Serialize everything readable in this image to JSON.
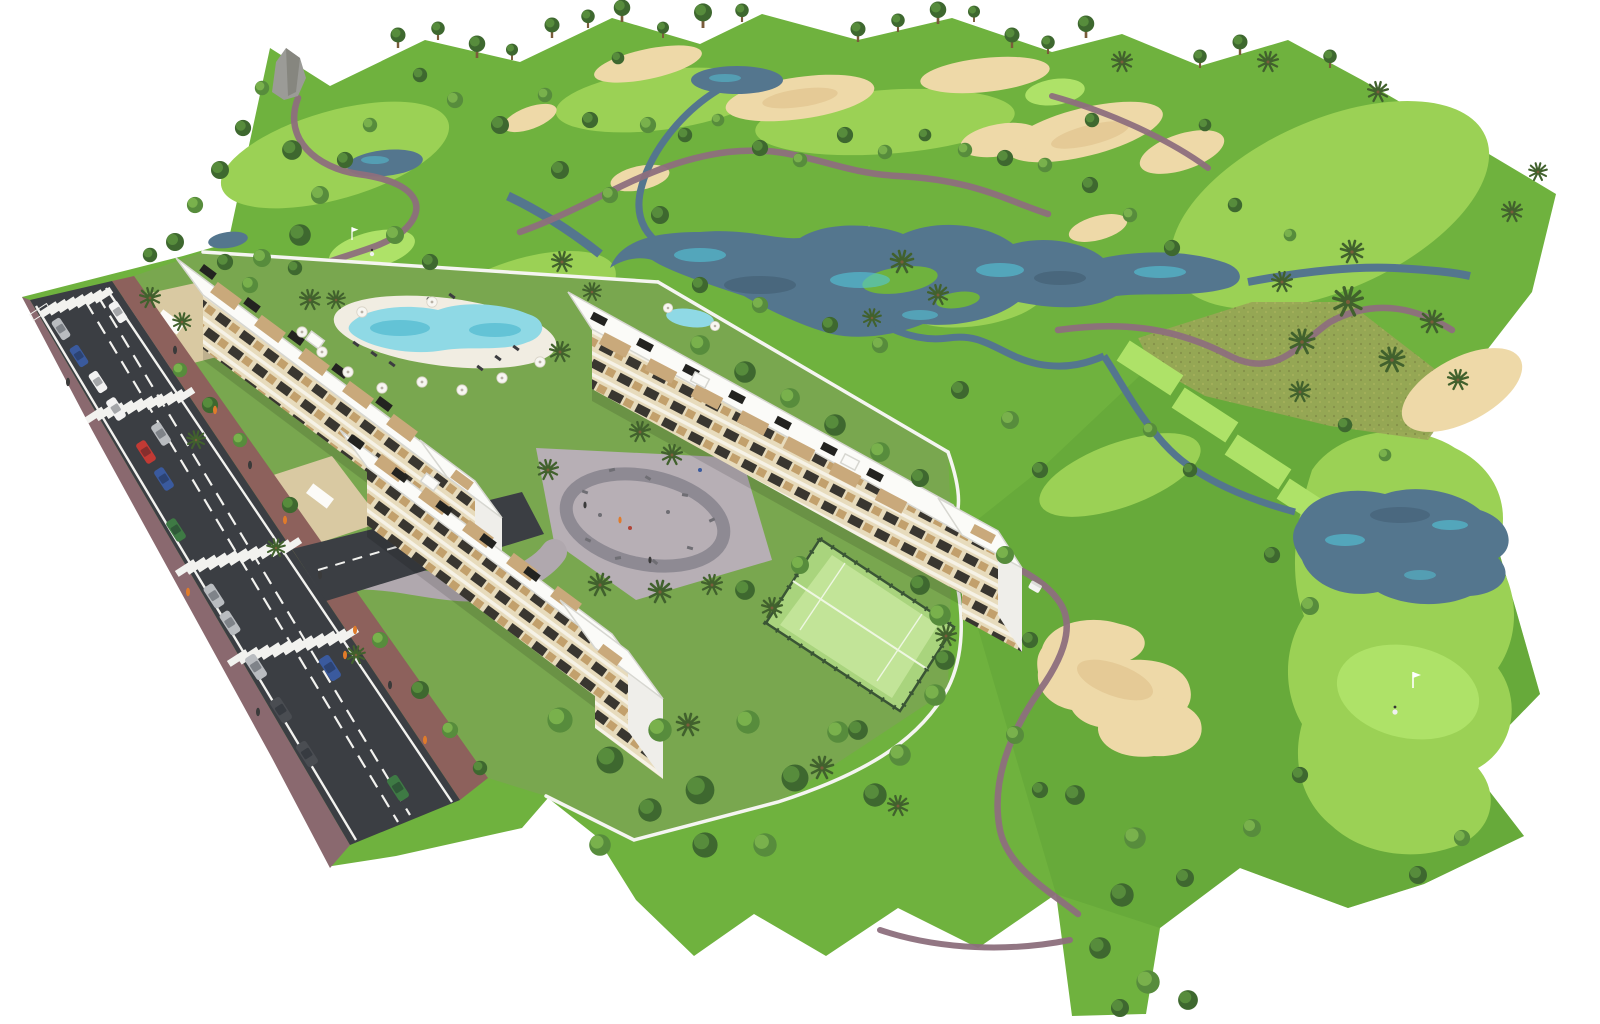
{
  "scene": {
    "title": "Golf resort apartment development — aerial 3D render",
    "description": "Bird's-eye architectural rendering of three white apartment blocks with roof terraces and wood-tone facades beside a golf course with lakes, sand bunkers, cart paths and palm trees; a street with parked cars and zebra crossings runs along the lower-left, with a lagoon pool, playground plaza and fenced padel courts inside the complex.",
    "background_color": "#ffffff"
  },
  "palette": {
    "grass": "#6fb23e",
    "grassDark": "#61a437",
    "devGrass": "#79a74f",
    "fairway": "#9bd155",
    "tee": "#aee268",
    "rough": "#99a557",
    "sand": "#eed9a8",
    "sandEdge": "#dbbc84",
    "water": "#54768e",
    "waterDeep": "#3c5668",
    "waterGlint": "#54c6d8",
    "path": "#8d6f7d",
    "road": "#3b3e43",
    "roadLine": "#f2f2ef",
    "sidewalk": "#8a696f",
    "sidewalkRed": "#8d615c",
    "wall": "#f5f5f1",
    "roof": "#fbfbf8",
    "roofLine": "#d7d7d1",
    "endWall": "#efeeea",
    "facade": "#e7dbbc",
    "facadeBand": "#f6f2e6",
    "facadeWin": "#393630",
    "facadeWood": "#c2a06c",
    "terrace": "#c9a97b",
    "panel": "#232320",
    "plaza": "#b7afb5",
    "plazaRing": "#8e8a93",
    "equipment": "#6f6e74",
    "court": "#a9d47d",
    "courtInner": "#c2e498",
    "courtLine": "#eef7e2",
    "fence": "#3a5535",
    "pool": "#8fd9e5",
    "poolDeep": "#3fb0cb",
    "deck": "#f1ede2",
    "treeDark": "#3e682f",
    "treeMid": "#578c3c",
    "treeLight": "#79b14c",
    "palm": "#41612d",
    "trunk": "#7a5c3a",
    "umbrella": "#f7f6f1",
    "lounger": "#3c3c40",
    "carWhite": "#f2f2f2",
    "carSilver": "#b9bcc0",
    "carBlue": "#3a5a9e",
    "carRed": "#c23a34",
    "carGreen": "#3e7a44",
    "carDark": "#4a4d52",
    "figure": "#3a3a3a",
    "figureOrange": "#e07b2a",
    "rock": "#9b9b97",
    "forecourt": "#d9c9a2"
  },
  "features": [
    "golf course",
    "central lake",
    "side lakes and streams",
    "sand bunkers",
    "cart paths",
    "tee boxes",
    "putting green with flag and golfer",
    "golf cart",
    "three apartment blocks with roof terraces and solar panels",
    "street with parked cars",
    "zebra crossings",
    "lagoon swimming pool with umbrellas",
    "playground / outdoor gym plaza",
    "fenced padel courts",
    "perimeter walls",
    "palm trees",
    "horizon tree line"
  ],
  "counts": {
    "apartment_blocks": 3,
    "end_towers": 3,
    "cars": 16,
    "crosswalks": 4,
    "water_bodies": 7,
    "bunkers": 11,
    "padel_courts": 2,
    "pool_umbrellas": 12,
    "horizon_trees": 20,
    "golfers": 2,
    "flags": 2
  }
}
